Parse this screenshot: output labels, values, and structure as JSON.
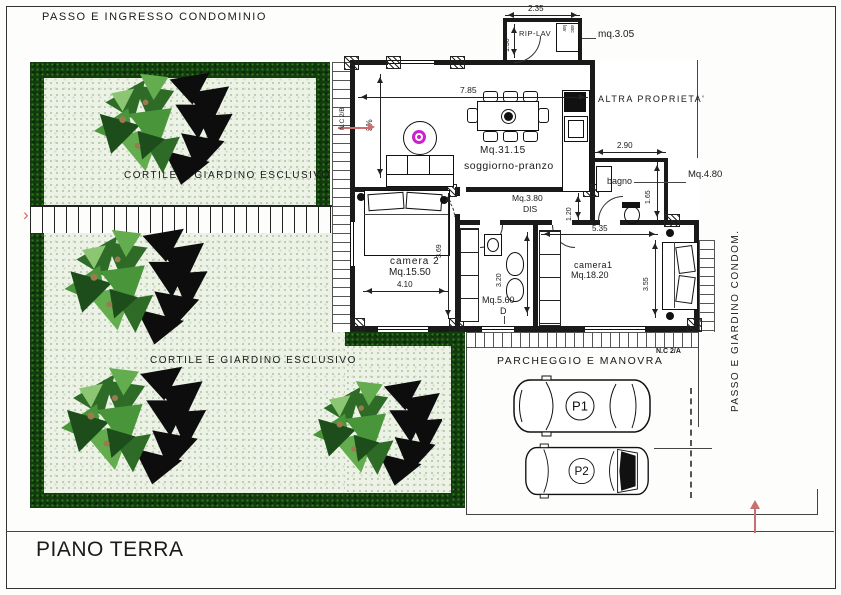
{
  "sheet": {
    "floor_label": "PIANO TERRA"
  },
  "labels": {
    "top": "PASSO  E  INGRESSO  CONDOMINIO",
    "right_vertical": "PASSO  E  GIARDINO  CONDOM.",
    "other_property": "ALTRA  PROPRIETA'",
    "garden_upper": "CORTILE  E  GIARDINO  ESCLUSIVO",
    "garden_lower": "CORTILE  E  GIARDINO  ESCLUSIVO",
    "parking": "PARCHEGGIO  E  MANOVRA",
    "parcel_a": "N.C 2/A",
    "parcel_b": "N.C 2/B",
    "spot1": "P1",
    "spot2": "P2"
  },
  "rooms": {
    "soggiorno": {
      "area": "Mq.31.15",
      "name": "soggiorno-pranzo"
    },
    "camera2": {
      "name": "camera 2",
      "area": "Mq.15.50"
    },
    "camera1": {
      "name": "camera1",
      "area": "Mq.18.20"
    },
    "bagno": {
      "name": "bagno",
      "area": "Mq.4.80"
    },
    "dis": {
      "area": "Mq.3.80",
      "name": "DIS"
    },
    "bagno2": {
      "area": "Mq.5.60",
      "tag": "D"
    },
    "riplav": {
      "name": "RIP-LAV",
      "area": "mq.3.05",
      "fixture_a": "lav",
      "fixture_b": "asc"
    }
  },
  "dimensions": {
    "annex_w": "2.35",
    "annex_h": "1.30",
    "soggiorno_w": "7.85",
    "slope": "3%",
    "bagno_w": "2.90",
    "bagno_h": "1.65",
    "dis_h": "1.20",
    "camera2_h": "3.69",
    "camera2_w": "4.10",
    "bagno2_h": "3.20",
    "camera1_w": "5.35",
    "camera1_h": "3.55"
  },
  "colors": {
    "hedge": "#123c0d",
    "garden_fill": "#edf2e6",
    "accent": "#c87070",
    "magenta": "#cc22cc",
    "wall": "#1a1a1a"
  }
}
